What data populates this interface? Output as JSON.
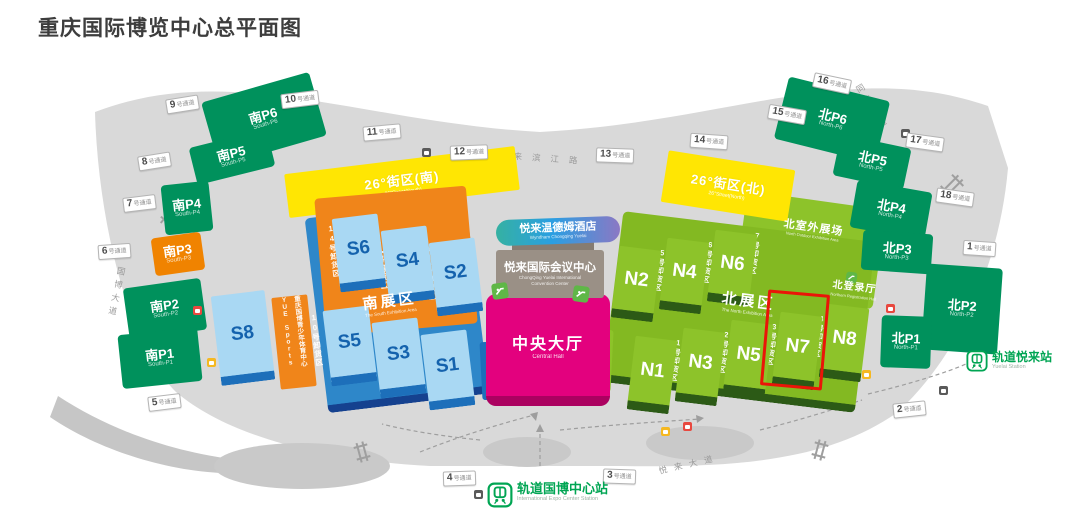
{
  "title": "重庆国际博览中心总平面图",
  "passages": {
    "suffix": "号通道",
    "n1": "1",
    "n2": "2",
    "n3": "3",
    "n4": "4",
    "n5": "5",
    "n6": "6",
    "n7": "7",
    "n8": "8",
    "n9": "9",
    "n10": "10",
    "n11": "11",
    "n12": "12",
    "n13": "13",
    "n14": "14",
    "n15": "15",
    "n16": "16",
    "n17": "17",
    "n18": "18"
  },
  "parking_south": {
    "p1": {
      "label": "南P1",
      "en": "South-P1"
    },
    "p2": {
      "label": "南P2",
      "en": "South-P2"
    },
    "p3": {
      "label": "南P3",
      "en": "South-P3"
    },
    "p4": {
      "label": "南P4",
      "en": "South-P4"
    },
    "p5": {
      "label": "南P5",
      "en": "South-P5"
    },
    "p6": {
      "label": "南P6",
      "en": "South-P6"
    }
  },
  "parking_north": {
    "p1": {
      "label": "北P1",
      "en": "North-P1"
    },
    "p2": {
      "label": "北P2",
      "en": "North-P2"
    },
    "p3": {
      "label": "北P3",
      "en": "North-P3"
    },
    "p4": {
      "label": "北P4",
      "en": "North-P4"
    },
    "p5": {
      "label": "北P5",
      "en": "North-P5"
    },
    "p6": {
      "label": "北P6",
      "en": "North-P6"
    }
  },
  "streets": {
    "south": {
      "label": "26°街区(南)",
      "en": "26°Street(South)"
    },
    "north": {
      "label": "26°街区(北)",
      "en": "26°Street(North)"
    }
  },
  "sports": {
    "name": "YUE Sports",
    "sub": "重庆国博青少年体育中心"
  },
  "halls_south": {
    "s1": "S1",
    "s2": "S2",
    "s3": "S3",
    "s4": "S4",
    "s5": "S5",
    "s6": "S6",
    "s8": "S8",
    "zone": "南展区",
    "zone_en": "The South Exhibition Area",
    "u8": "8号卸货区",
    "u9": "9号卸货区",
    "u10": "10号卸货区",
    "u12": "12号卸货区",
    "u13": "13号卸货区",
    "u14": "14号卸货区"
  },
  "halls_north": {
    "n1": "N1",
    "n2": "N2",
    "n3": "N3",
    "n4": "N4",
    "n5": "N5",
    "n6": "N6",
    "n7": "N7",
    "n8": "N8",
    "zone": "北展区",
    "zone_en": "The North Exhibition Area",
    "outdoor": "北室外展场",
    "outdoor_en": "North Outdoor Exhibition Area",
    "registration": "北登录厅",
    "registration_en": "Northern Registration Hall",
    "u1": "1号卸货区",
    "u2": "2号卸货区",
    "u3": "3号卸货区",
    "u4": "4号卸货区",
    "u5": "5号卸货区",
    "u6": "6号卸货区",
    "u7": "7号卸货区"
  },
  "center": {
    "hotel": "悦来温德姆酒店",
    "hotel_en": "Wyndham Chongqing Yuelai",
    "convention": "悦来国际会议中心",
    "convention_en": "ChongQing Yuelai International Convention Center",
    "hall": "中央大厅",
    "hall_en": "Central Hall"
  },
  "stations": {
    "expo": {
      "name": "轨道国博中心站",
      "en": "International Expo Center Station"
    },
    "yuelai": {
      "name": "轨道悦来站",
      "en": "Yuelai Station"
    }
  },
  "roads": {
    "guobo": "国博大道",
    "binjiang": "悦来滨江路",
    "tongmao": "同茂大道",
    "yuelai": "悦来大道"
  },
  "colors": {
    "parking_green": "#00915c",
    "hall_blue": "#a9d8f3",
    "podium_blue": "#2e87c9",
    "hall_green": "#8dc32a",
    "orange": "#f08300",
    "magenta": "#e3017e",
    "yellow": "#ffe603",
    "metro_green": "#00a553",
    "highlight_red": "#ea1508"
  }
}
